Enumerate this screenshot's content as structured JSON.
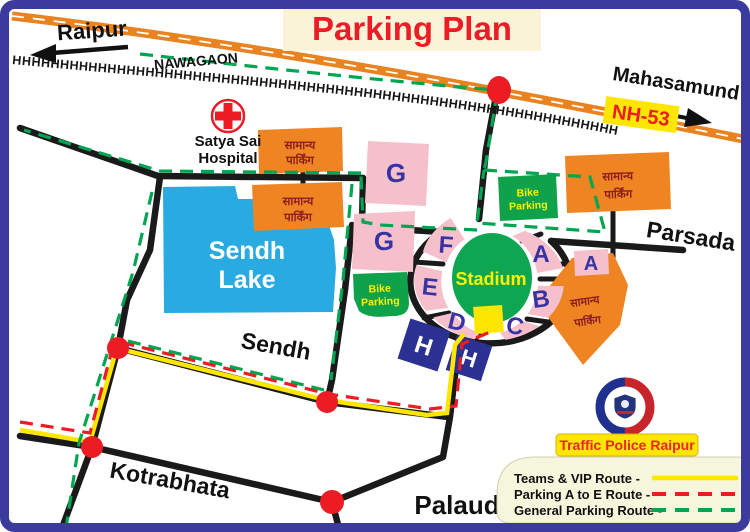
{
  "title": "Parking Plan",
  "places": {
    "raipur": "Raipur",
    "nawagaon": "NAWAGAON",
    "mahasamund": "Mahasamund",
    "nh53": "NH-53",
    "parsada": "Parsada",
    "sendh": "Sendh",
    "kotrabhata": "Kotrabhata",
    "palaud": "Palaud",
    "lake_line1": "Sendh",
    "lake_line2": "Lake",
    "hospital_line1": "Satya Sai",
    "hospital_line2": "Hospital",
    "stadium": "Stadium"
  },
  "parking": {
    "general_line1": "सामान्य",
    "general_line2": "पार्किंग",
    "bike_line1": "Bike",
    "bike_line2": "Parking"
  },
  "zones": {
    "g_upper": "G",
    "g_lower": "G",
    "f": "F",
    "e": "E",
    "d": "D",
    "c": "C",
    "b": "B",
    "a_ring": "A",
    "a_east": "A",
    "h_west": "H",
    "h_east": "H"
  },
  "railway": {
    "hatch": "HHHHHHHHHHHHHHHHHHHHHHHHHHHHHHHHHHHHHHHHHHHHHHHHHHHHHHHHHHHHHHHH"
  },
  "legend": {
    "badge": "Traffic Police Raipur",
    "items": [
      {
        "label": "Teams & VIP Route -",
        "color": "#FFE600",
        "style": "solid"
      },
      {
        "label": "Parking A to E Route -",
        "color": "#EC1C24",
        "style": "dashed"
      },
      {
        "label": "General Parking Route -",
        "color": "#00A551",
        "style": "dashed"
      }
    ]
  },
  "colors": {
    "border": "#3B3B9D",
    "highway_orange": "#E9831F",
    "lake_blue": "#29ABE2",
    "zone_pink": "#F5BFCB",
    "zone_letter_blue": "#3733A3",
    "stadium_green": "#0FA651",
    "bike_green": "#0FA24B",
    "parking_orange": "#EF8423",
    "hindi_text": "#8C1D1D",
    "h_navy": "#2B3192",
    "dot_red": "#EC1C24",
    "route_vip_yellow": "#FFE600",
    "route_parking_red": "#EC1C24",
    "route_general_green": "#00A551",
    "title_red": "#EC1C24",
    "title_bg_cream": "#FBF3D7"
  }
}
